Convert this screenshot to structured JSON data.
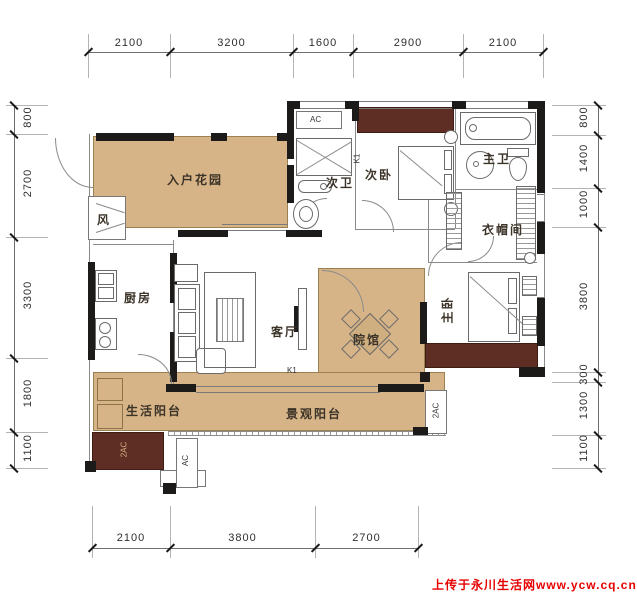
{
  "title": "residential floor plan",
  "palette": {
    "floor_tan": "#d7b487",
    "wood_maroon": "#5e2d23",
    "wall_black": "#1d1b1a",
    "line_gray": "#8a8a8a",
    "dim_text": "#2e2e2e",
    "watermark_red": "#e60000"
  },
  "rooms": {
    "entry_garden": {
      "label": "入户花园"
    },
    "air_shaft": {
      "label": "风"
    },
    "kitchen": {
      "label": "厨房"
    },
    "living_room": {
      "label": "客厅"
    },
    "courtyard": {
      "label": "院馆"
    },
    "second_bath": {
      "label": "次卫"
    },
    "second_bedroom": {
      "label": "次卧"
    },
    "master_bath": {
      "label": "主卫"
    },
    "cloakroom": {
      "label": "衣帽间"
    },
    "master_bedroom": {
      "label": "主卧"
    },
    "service_balcony": {
      "label": "生活阳台"
    },
    "view_balcony": {
      "label": "景观阳台"
    }
  },
  "markers": {
    "ac_top": "AC",
    "k1_upper": "K1",
    "k1_lower": "K1",
    "ac_bottom_left": "AC",
    "ac_planter": "2AC",
    "ac_right": "2AC"
  },
  "dimensions": {
    "top": [
      "2100",
      "3200",
      "1600",
      "2900",
      "2100"
    ],
    "bottom": [
      "2100",
      "3800",
      "2700"
    ],
    "left": [
      "800",
      "2700",
      "3300",
      "1800",
      "1100"
    ],
    "right": [
      "800",
      "1400",
      "1000",
      "3800",
      "300",
      "1300",
      "1100"
    ]
  },
  "watermark": {
    "text": "上传于永川生活网www.ycw.cq.cn"
  }
}
